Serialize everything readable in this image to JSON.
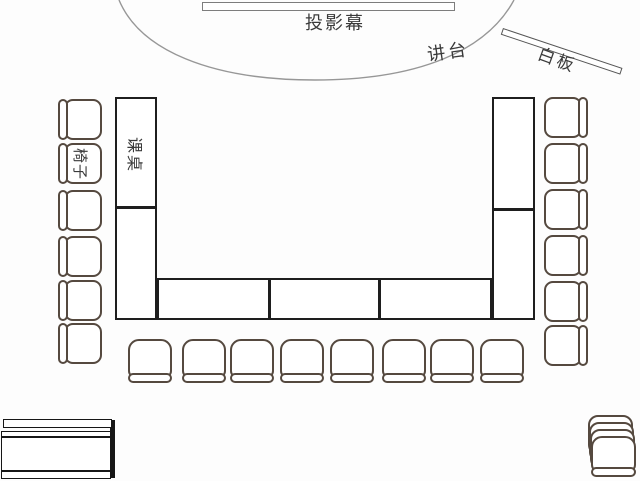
{
  "title": "教室布局图",
  "labels": {
    "screen": "投影幕",
    "podium": "讲台",
    "whiteboard": "白板",
    "chair": "椅子",
    "desk": "课桌"
  },
  "colors": {
    "background": "#fdfdfd",
    "desk_stroke": "#1e1e1e",
    "chair_stroke": "#55493f",
    "arc_stroke": "#979797",
    "screen_stroke": "#7d7d7d",
    "text": "#3a3a3a"
  },
  "layout_summary": {
    "left_chairs": 6,
    "right_chairs": 6,
    "bottom_chairs": 8,
    "stacked_chairs_bottom_right": 4,
    "left_desk_sections": 2,
    "right_desk_sections": 2,
    "bottom_desk_sections": 3,
    "side_table_bottom_left": 1
  }
}
